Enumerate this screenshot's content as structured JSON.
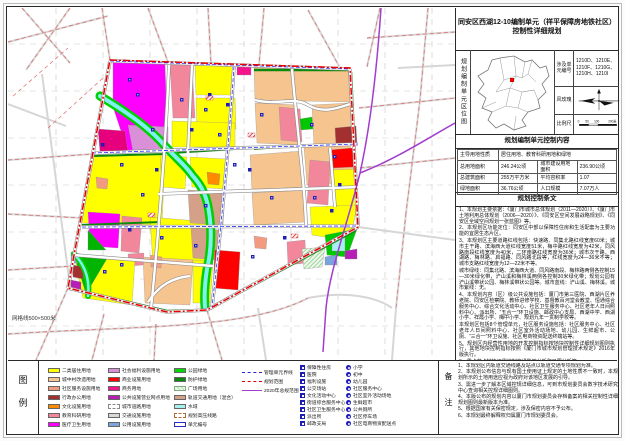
{
  "title": {
    "line1": "同安区西湖12-10编制单元（祥平保障房地铁社区）",
    "line2": "控制性详细规划"
  },
  "location": {
    "side_label": "规划编制单元区位图",
    "codes_label": "涉及单元编号",
    "codes_value": "1210D、1210E、1210F、1210G、1210H、1210I",
    "wind_label": "风玫瑰",
    "scale_label": "比例尺",
    "scale_ticks": [
      "0",
      "50",
      "100",
      "200米"
    ]
  },
  "control": {
    "header": "规划编制单元控制内容",
    "r1l": "主导用地性质",
    "r1v": "居住用地、教育科研用地和绿地",
    "r2l1": "总用地面积",
    "r2v1": "246.24公顷",
    "r2l2": "城市建设用地面积",
    "r2v2": "236.90公顷",
    "r3l1": "总建筑面积",
    "r3v1": "255万平方米",
    "r3l2": "平均容积率",
    "r3v2": "1.07",
    "r4l1": "绿地面积",
    "r4v1": "36.76公顷",
    "r4l2": "人口规模",
    "r4v2": "7.07万人"
  },
  "provisions": {
    "header": "规划控制条文",
    "items": [
      "1、本规划主要依据：《厦门市城市总体规划（2011—2020）》、《厦门市土地利用总体规划（2006—2020）》、《同安区空间发展战略规划》、《同安区全域空间规划一张蓝图》等。",
      "2、本规划区功能定位：同安区中部以保障性住房和生活配套为主要功能的宜居生态片区。",
      "3、本规划区主要道路红线包括：快速路、同集北路红线宽度60米；城市主干路、滨海西大道红线宽度51米，梅中路红线宽度为42米，同风路南段红线宽度为40米，二环南路红线宽度为36米；城市次干路、西湖路、梅林路、启福路、同风路北段等，红线宽度为24—36米不等；城市支路红线宽度为12—22米不等。",
      "城市绿线：同集北路、滨海西大道、同风路南段、梅林路两侧各控制15—30米绿化带，浐山溪和梅林溪两侧各控制30米绿化带；规划公园有浐山溪带状公园、梅林溪带状公园等。城市蓝线：浐山溪、梅林溪。城市紫线：无。",
      "4、本规划内容（区）级公共设施包括：厦门市第三医院、西湖片区养老院、同安区检察院、教师进修学校、基督教百河堂会教堂、恒通综合服务中心、综合文化活动中心、社区卫生服务中心、社区老年人日间照料中心、派出所、“五合一”环卫设施、邮政中心支局、西湖中学、西湖小学、祥霞小学、梅中小学、规划九年一贯制学校等。",
      "本规划区包括8个管理单元，社区服务设施包括：社区服务中心、社区老年人日间照料中心、社区室外活动场地、幼儿园、生鲜超市、公厕、“三合一”环卫设施、社区电商物资配送终端站等。",
      "5、规划区内经营性用地的开发控制指标按地块控制性详细规划图则执行，其他地块控制指标按照《厦门市城市规划管理技术规定》2016年版执行。",
      "6、重点节点地块还需编制交通影响分析和日照分析等。",
      "7、规划区内用地性质混合仅供参考，具体以实际用地为准。"
    ]
  },
  "legend": {
    "label": "图例",
    "col1": [
      {
        "label": "二类居住用地",
        "color": "#FFFF00"
      },
      {
        "label": "城中村改造用地",
        "color": "#F6C48E"
      },
      {
        "label": "社区服务设施用地",
        "color": "#F29B80"
      },
      {
        "label": "行政办公用地",
        "color": "#A33030"
      },
      {
        "label": "文化设施用地",
        "color": "#FF8A00"
      },
      {
        "label": "教育科研用地",
        "color": "#F2879C"
      },
      {
        "label": "医疗卫生用地",
        "color": "#FF00FF"
      }
    ],
    "col2": [
      {
        "label": "社会福利设施用地",
        "color": "#DA8FD9"
      },
      {
        "label": "商业设施用地",
        "color": "#FF0000"
      },
      {
        "label": "商务用地",
        "color": "#F5148C"
      },
      {
        "label": "公共设施营业网点用地",
        "color": "#B61EB6"
      },
      {
        "label": "城市道路用地",
        "color": "#FFFFFF",
        "type": "road"
      },
      {
        "label": "交通设施用地",
        "color": "#D9D9D9"
      },
      {
        "label": "公用设施用地",
        "color": "#7AA4DB"
      }
    ],
    "col3": [
      {
        "label": "公园绿地",
        "color": "#00D800"
      },
      {
        "label": "防护绿地",
        "color": "#0A8A0A"
      },
      {
        "label": "广场用地",
        "color": "#DFF0DC",
        "type": "hatch"
      },
      {
        "label": "轨道交通用地（混合）",
        "color": "#D4A188"
      },
      {
        "label": "水域",
        "color": "#A8F0F0"
      },
      {
        "label": "规划高压线路",
        "color": "#FFFFFF",
        "type": "dashedbox"
      },
      {
        "label": "单元编号",
        "color": "#FFFFFF",
        "type": "unitbox"
      }
    ],
    "lines": [
      {
        "label": "管理单元界线",
        "style": "blue-dashdot",
        "color": "#2525D8"
      },
      {
        "label": "规划范围",
        "style": "red-dashdot",
        "color": "#E00000"
      },
      {
        "label": "2020年总规范围",
        "style": "purple-solid",
        "color": "#A13CCF"
      }
    ],
    "squares": [
      {
        "label": "保障性住房",
        "icon": "affordable-housing-icon"
      },
      {
        "label": "医院",
        "icon": "hospital-icon"
      },
      {
        "label": "福利设施",
        "icon": "welfare-facility-icon"
      },
      {
        "label": "公交场站",
        "icon": "bus-station-icon"
      },
      {
        "label": "文化活动中心",
        "icon": "culture-center-icon"
      },
      {
        "label": "街道综合服务中心",
        "icon": "street-service-center-icon"
      },
      {
        "label": "社区卫生服务中心",
        "icon": "community-clinic-icon"
      },
      {
        "label": "派出所",
        "icon": "police-station-icon"
      },
      {
        "label": "邮政支局",
        "icon": "post-office-icon"
      }
    ],
    "circles": [
      {
        "label": "小学",
        "icon": "primary-school-icon"
      },
      {
        "label": "初中",
        "icon": "middle-school-icon"
      },
      {
        "label": "幼儿园",
        "icon": "kindergarten-icon"
      },
      {
        "label": "社区服务中心",
        "icon": "community-service-center-icon"
      },
      {
        "label": "社区室外活动场地",
        "icon": "outdoor-activity-ground-icon"
      },
      {
        "label": "生鲜超市",
        "icon": "fresh-market-icon"
      },
      {
        "label": "公共厕所",
        "icon": "public-toilet-icon"
      },
      {
        "label": "社区停车场",
        "icon": "community-parking-icon"
      },
      {
        "label": "社区电商物资配送点",
        "icon": "delivery-point-icon"
      }
    ]
  },
  "notes": {
    "label": "备注",
    "items": [
      "1、本规划区内轨道交通线路及站点以轨道交通专项规划为准。",
      "2、本规划公布信息与现有国土使用证上规定的土地性质不一致时，本规划所示的土地用途应视为政府对该地区发展的引导。",
      "3、需进一步了解本区域控规详细信息，可到市规划委员会数字技术研究中心查询相关控规详细图则。",
      "4、本版公布的规划内容以厦门市规划委员会存档备案的相关控制性详细规划图则最新版本为准。",
      "5、根据国家有关保密规定，涉及保密内容不予公布。",
      "6、本规划最终解释权归属厦门市规划委员会。"
    ]
  },
  "map": {
    "grid_note": "网格线500×500米",
    "boundary_color": "#E80000",
    "master_plan_line_color": "#A13CCF",
    "unit_line_color": "#3030F0"
  }
}
